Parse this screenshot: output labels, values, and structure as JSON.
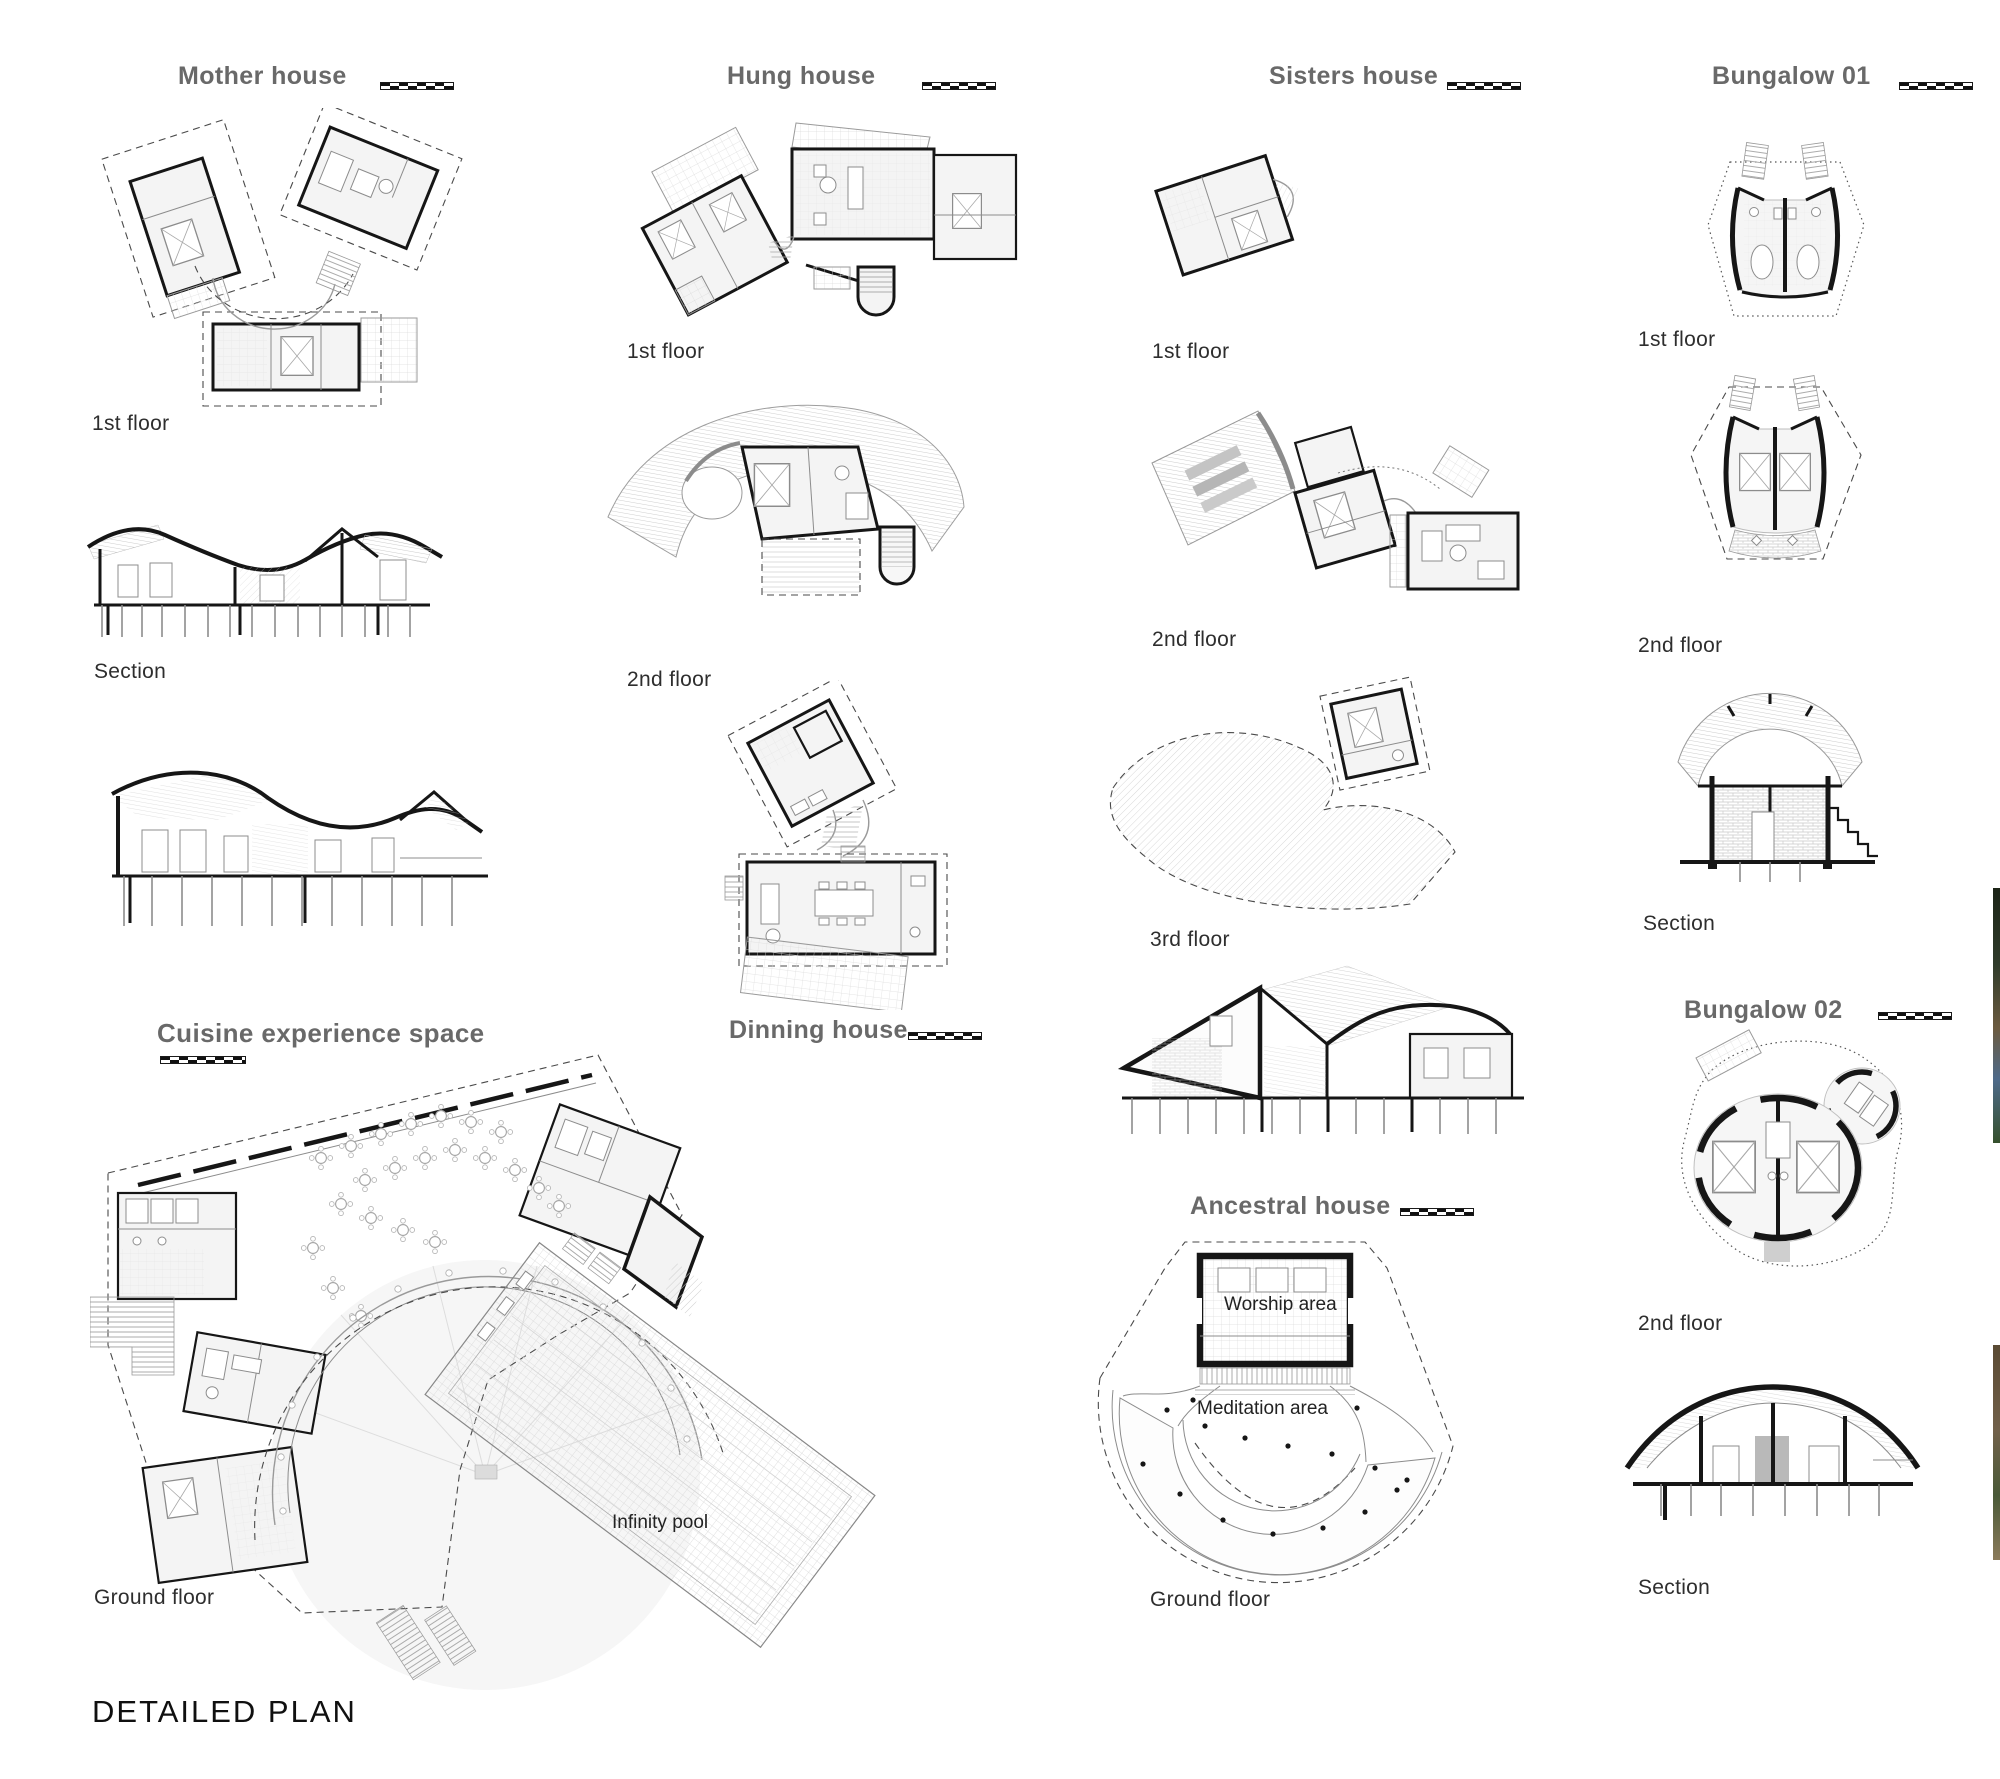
{
  "sheet": {
    "footer": "DETAILED PLAN",
    "background": "#ffffff"
  },
  "colors": {
    "title_gray": "#696969",
    "label_dark": "#2e2e2e",
    "wall_black": "#161616",
    "line_gray": "#9a9a9a"
  },
  "icons": {
    "scale_bar": "scale-bar"
  },
  "houses": {
    "mother": {
      "title": "Mother house",
      "labels": {
        "floor1": "1st floor",
        "section": "Section"
      }
    },
    "hung": {
      "title": "Hung house",
      "labels": {
        "floor1": "1st floor",
        "floor2": "2nd floor"
      }
    },
    "sisters": {
      "title": "Sisters house",
      "labels": {
        "floor1": "1st floor",
        "floor2": "2nd floor",
        "floor3": "3rd floor"
      }
    },
    "bungalow01": {
      "title": "Bungalow 01",
      "labels": {
        "floor1": "1st floor",
        "floor2": "2nd floor",
        "section": "Section"
      }
    },
    "cuisine": {
      "title": "Cuisine experience space",
      "labels": {
        "ground": "Ground floor",
        "pool": "Infinity pool"
      }
    },
    "dinning": {
      "title": "Dinning house"
    },
    "ancestral": {
      "title": "Ancestral house",
      "labels": {
        "worship": "Worship area",
        "meditation": "Meditation area",
        "ground": "Ground floor"
      }
    },
    "bungalow02": {
      "title": "Bungalow 02",
      "labels": {
        "floor2": "2nd floor",
        "section": "Section"
      }
    }
  }
}
